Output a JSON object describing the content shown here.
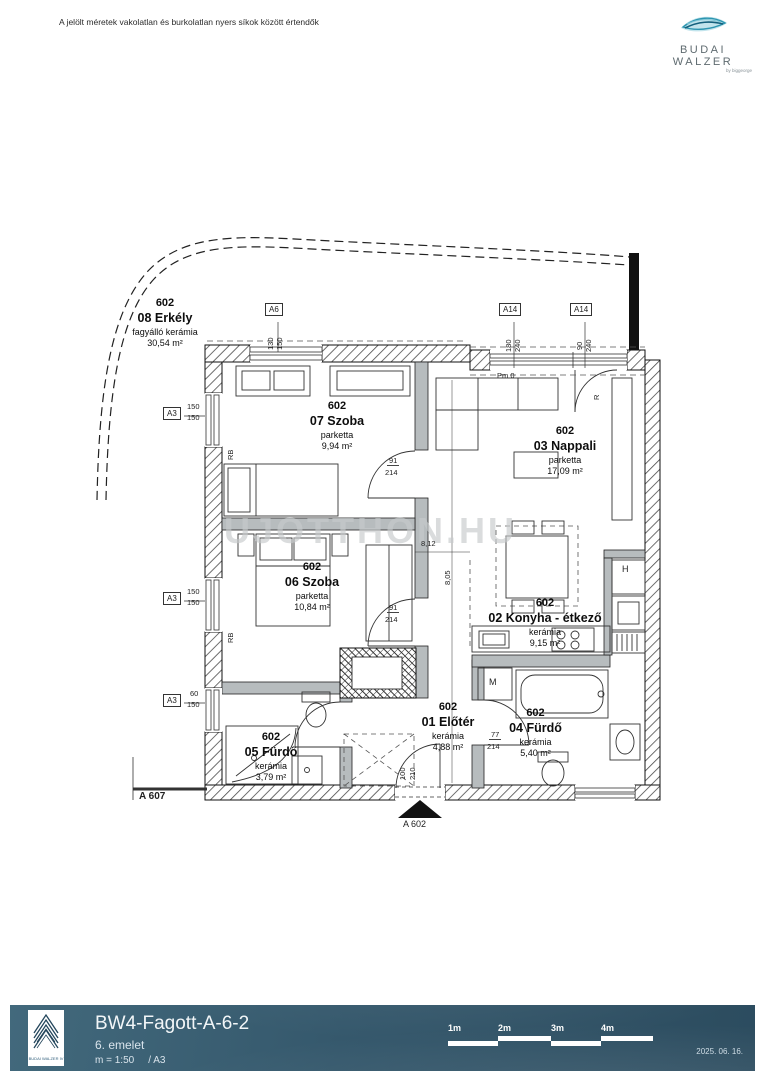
{
  "header": {
    "disclaimer": "A jelölt méretek vakolatlan és burkolatlan nyers síkok között értendők",
    "brand": "BUDAI WALZER",
    "brand_sub": "by biggeorge"
  },
  "plan": {
    "watermark": "UJOTTHON.HU",
    "rooms": [
      {
        "unit": "602",
        "name": "08 Erkély",
        "material": "fagyálló kerámia",
        "area": "30,54 m²"
      },
      {
        "unit": "602",
        "name": "07 Szoba",
        "material": "parketta",
        "area": "9,94 m²"
      },
      {
        "unit": "602",
        "name": "03 Nappali",
        "material": "parketta",
        "area": "17,09 m²"
      },
      {
        "unit": "602",
        "name": "06 Szoba",
        "material": "parketta",
        "area": "10,84 m²"
      },
      {
        "unit": "602",
        "name": "02 Konyha - étkező",
        "material": "kerámia",
        "area": "9,15 m²"
      },
      {
        "unit": "602",
        "name": "01 Előtér",
        "material": "kerámia",
        "area": "4,88 m²"
      },
      {
        "unit": "602",
        "name": "04 Fürdő",
        "material": "kerámia",
        "area": "5,40 m²"
      },
      {
        "unit": "602",
        "name": "05 Fürdő",
        "material": "kerámia",
        "area": "3,79 m²"
      }
    ],
    "annotations": [
      {
        "text": "A6"
      },
      {
        "text": "130"
      },
      {
        "text": "150"
      },
      {
        "text": "A14"
      },
      {
        "text": "180"
      },
      {
        "text": "240"
      },
      {
        "text": "A14"
      },
      {
        "text": "90"
      },
      {
        "text": "240"
      },
      {
        "text": "A3"
      },
      {
        "text": "150"
      },
      {
        "text": "150"
      },
      {
        "text": "A3"
      },
      {
        "text": "150"
      },
      {
        "text": "150"
      },
      {
        "text": "A3"
      },
      {
        "text": "60"
      },
      {
        "text": "150"
      },
      {
        "text": "RB"
      },
      {
        "text": "RB"
      },
      {
        "text": "91"
      },
      {
        "text": "214"
      },
      {
        "text": "91"
      },
      {
        "text": "214"
      },
      {
        "text": "77"
      },
      {
        "text": "214"
      },
      {
        "text": "8,12"
      },
      {
        "text": "8,05"
      },
      {
        "text": "Pm 0"
      },
      {
        "text": "100"
      },
      {
        "text": "210"
      },
      {
        "text": "M"
      },
      {
        "text": "H"
      },
      {
        "text": "R"
      },
      {
        "text": "A 607"
      },
      {
        "text": "A 602"
      }
    ]
  },
  "footer": {
    "title": "BW4-Fagott-A-6-2",
    "floor": "6. emelet",
    "scale": "m = 1:50",
    "paper": "/ A3",
    "logo_caption": "BUDAI WALZER IV",
    "scalebar": [
      "1m",
      "2m",
      "3m",
      "4m"
    ],
    "date": "2025. 06. 16."
  }
}
